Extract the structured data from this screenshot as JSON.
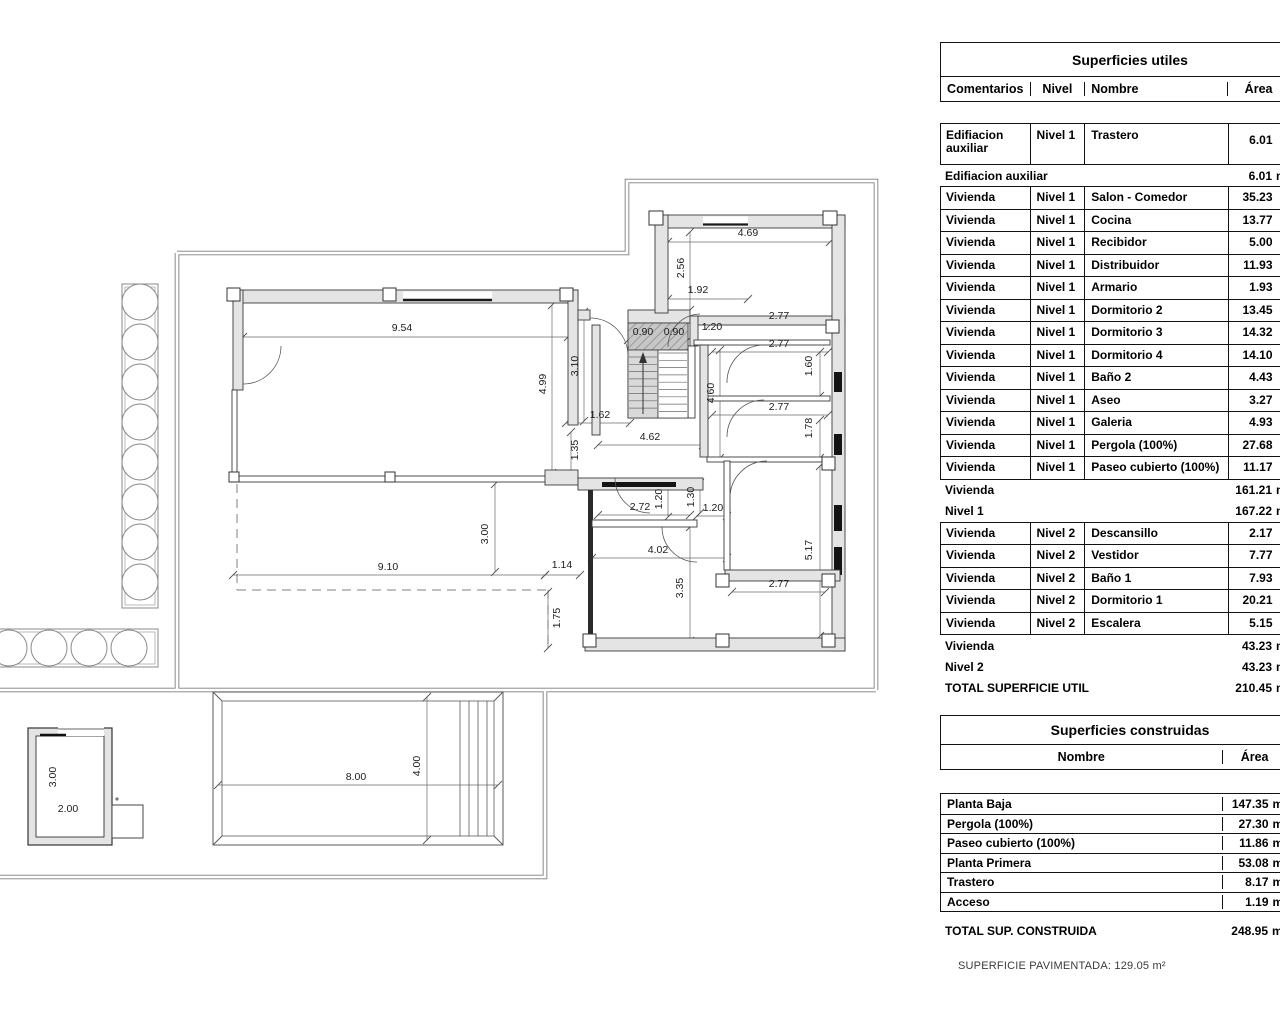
{
  "tables": {
    "utiles": {
      "title": "Superficies utiles",
      "columns": [
        "Comentarios",
        "Nivel",
        "Nombre",
        "Área"
      ],
      "unit": "m²",
      "rows": [
        {
          "type": "data2",
          "block": 1,
          "com": "Edifiacion auxiliar",
          "nivel": "Nivel 1",
          "nombre": "Trastero",
          "area": "6.01"
        },
        {
          "type": "summary",
          "label": "Edifiacion auxiliar",
          "area": "6.01"
        },
        {
          "type": "data",
          "block": 2,
          "com": "Vivienda",
          "nivel": "Nivel 1",
          "nombre": "Salon - Comedor",
          "area": "35.23"
        },
        {
          "type": "data",
          "block": 2,
          "com": "Vivienda",
          "nivel": "Nivel 1",
          "nombre": "Cocina",
          "area": "13.77"
        },
        {
          "type": "data",
          "block": 2,
          "com": "Vivienda",
          "nivel": "Nivel 1",
          "nombre": "Recibidor",
          "area": "5.00"
        },
        {
          "type": "data",
          "block": 2,
          "com": "Vivienda",
          "nivel": "Nivel 1",
          "nombre": "Distribuidor",
          "area": "11.93"
        },
        {
          "type": "data",
          "block": 2,
          "com": "Vivienda",
          "nivel": "Nivel 1",
          "nombre": "Armario",
          "area": "1.93"
        },
        {
          "type": "data",
          "block": 2,
          "com": "Vivienda",
          "nivel": "Nivel 1",
          "nombre": "Dormitorio 2",
          "area": "13.45"
        },
        {
          "type": "data",
          "block": 2,
          "com": "Vivienda",
          "nivel": "Nivel 1",
          "nombre": "Dormitorio 3",
          "area": "14.32"
        },
        {
          "type": "data",
          "block": 2,
          "com": "Vivienda",
          "nivel": "Nivel 1",
          "nombre": "Dormitorio 4",
          "area": "14.10"
        },
        {
          "type": "data",
          "block": 2,
          "com": "Vivienda",
          "nivel": "Nivel 1",
          "nombre": "Baño 2",
          "area": "4.43"
        },
        {
          "type": "data",
          "block": 2,
          "com": "Vivienda",
          "nivel": "Nivel 1",
          "nombre": "Aseo",
          "area": "3.27"
        },
        {
          "type": "data",
          "block": 2,
          "com": "Vivienda",
          "nivel": "Nivel 1",
          "nombre": "Galeria",
          "area": "4.93"
        },
        {
          "type": "data",
          "block": 2,
          "com": "Vivienda",
          "nivel": "Nivel 1",
          "nombre": "Pergola (100%)",
          "area": "27.68"
        },
        {
          "type": "data",
          "block": 2,
          "com": "Vivienda",
          "nivel": "Nivel 1",
          "nombre": "Paseo cubierto (100%)",
          "area": "11.17"
        },
        {
          "type": "summary",
          "label": "Vivienda",
          "area": "161.21"
        },
        {
          "type": "summary",
          "label": "Nivel 1",
          "area": "167.22"
        },
        {
          "type": "data",
          "block": 3,
          "com": "Vivienda",
          "nivel": "Nivel 2",
          "nombre": "Descansillo",
          "area": "2.17"
        },
        {
          "type": "data",
          "block": 3,
          "com": "Vivienda",
          "nivel": "Nivel 2",
          "nombre": "Vestidor",
          "area": "7.77"
        },
        {
          "type": "data",
          "block": 3,
          "com": "Vivienda",
          "nivel": "Nivel 2",
          "nombre": "Baño 1",
          "area": "7.93"
        },
        {
          "type": "data",
          "block": 3,
          "com": "Vivienda",
          "nivel": "Nivel 2",
          "nombre": "Dormitorio 1",
          "area": "20.21"
        },
        {
          "type": "data",
          "block": 3,
          "com": "Vivienda",
          "nivel": "Nivel 2",
          "nombre": "Escalera",
          "area": "5.15"
        },
        {
          "type": "summary",
          "label": "Vivienda",
          "area": "43.23"
        },
        {
          "type": "summary",
          "label": "Nivel 2",
          "area": "43.23"
        },
        {
          "type": "total",
          "label": "TOTAL SUPERFICIE UTIL",
          "area": "210.45"
        }
      ]
    },
    "construidas": {
      "title": "Superficies construidas",
      "columns": [
        "Nombre",
        "Área"
      ],
      "unit": "m²",
      "rows": [
        {
          "nombre": "Planta Baja",
          "area": "147.35"
        },
        {
          "nombre": "Pergola (100%)",
          "area": "27.30"
        },
        {
          "nombre": "Paseo cubierto (100%)",
          "area": "11.86"
        },
        {
          "nombre": "Planta Primera",
          "area": "53.08"
        },
        {
          "nombre": "Trastero",
          "area": "8.17"
        },
        {
          "nombre": "Acceso",
          "area": "1.19"
        }
      ],
      "total": {
        "label": "TOTAL SUP. CONSTRUIDA",
        "area": "248.95"
      }
    }
  },
  "footer": {
    "note": "SUPERFICIE PAVIMENTADA: 129.05 m²"
  },
  "plan": {
    "trees": {
      "vertical_count": 8,
      "horizontal_count": 5
    },
    "dimensions": [
      {
        "t": "9.54",
        "x": 402,
        "y": 331,
        "r": 0
      },
      {
        "t": "4.99",
        "x": 546,
        "y": 384,
        "r": -90
      },
      {
        "t": "3.10",
        "x": 578,
        "y": 366,
        "r": -90
      },
      {
        "t": "0.90",
        "x": 643,
        "y": 335,
        "r": 0
      },
      {
        "t": "0.90",
        "x": 674,
        "y": 335,
        "r": 0
      },
      {
        "t": "1.20",
        "x": 712,
        "y": 330,
        "r": 0
      },
      {
        "t": "1.92",
        "x": 698,
        "y": 293,
        "r": 0
      },
      {
        "t": "2.56",
        "x": 684,
        "y": 268,
        "r": -90
      },
      {
        "t": "4.69",
        "x": 748,
        "y": 236,
        "r": 0
      },
      {
        "t": "2.77",
        "x": 779,
        "y": 319,
        "r": 0
      },
      {
        "t": "2.77",
        "x": 779,
        "y": 347,
        "r": 0
      },
      {
        "t": "1.60",
        "x": 812,
        "y": 366,
        "r": -90
      },
      {
        "t": "2.77",
        "x": 779,
        "y": 410,
        "r": 0
      },
      {
        "t": "1.78",
        "x": 812,
        "y": 428,
        "r": -90
      },
      {
        "t": "4.60",
        "x": 714,
        "y": 393,
        "r": -90
      },
      {
        "t": "1.62",
        "x": 600,
        "y": 418,
        "r": 0
      },
      {
        "t": "4.62",
        "x": 650,
        "y": 440,
        "r": 0
      },
      {
        "t": "1.35",
        "x": 578,
        "y": 450,
        "r": -90
      },
      {
        "t": "2.72",
        "x": 640,
        "y": 510,
        "r": 0
      },
      {
        "t": "1.20",
        "x": 662,
        "y": 499,
        "r": -90
      },
      {
        "t": "1.30",
        "x": 694,
        "y": 497,
        "r": -90
      },
      {
        "t": "1.20",
        "x": 713,
        "y": 511,
        "r": 0
      },
      {
        "t": "4.02",
        "x": 658,
        "y": 553,
        "r": 0
      },
      {
        "t": "3.35",
        "x": 683,
        "y": 588,
        "r": -90
      },
      {
        "t": "2.77",
        "x": 779,
        "y": 587,
        "r": 0
      },
      {
        "t": "5.17",
        "x": 812,
        "y": 550,
        "r": -90
      },
      {
        "t": "3.00",
        "x": 488,
        "y": 534,
        "r": -90
      },
      {
        "t": "9.10",
        "x": 388,
        "y": 570,
        "r": 0
      },
      {
        "t": "1.14",
        "x": 562,
        "y": 568,
        "r": 0
      },
      {
        "t": "1.75",
        "x": 560,
        "y": 618,
        "r": -90
      },
      {
        "t": "8.00",
        "x": 356,
        "y": 780,
        "r": 0
      },
      {
        "t": "4.00",
        "x": 420,
        "y": 766,
        "r": -90
      },
      {
        "t": "3.00",
        "x": 56,
        "y": 777,
        "r": -90
      },
      {
        "t": "2.00",
        "x": 68,
        "y": 812,
        "r": 0
      }
    ]
  }
}
